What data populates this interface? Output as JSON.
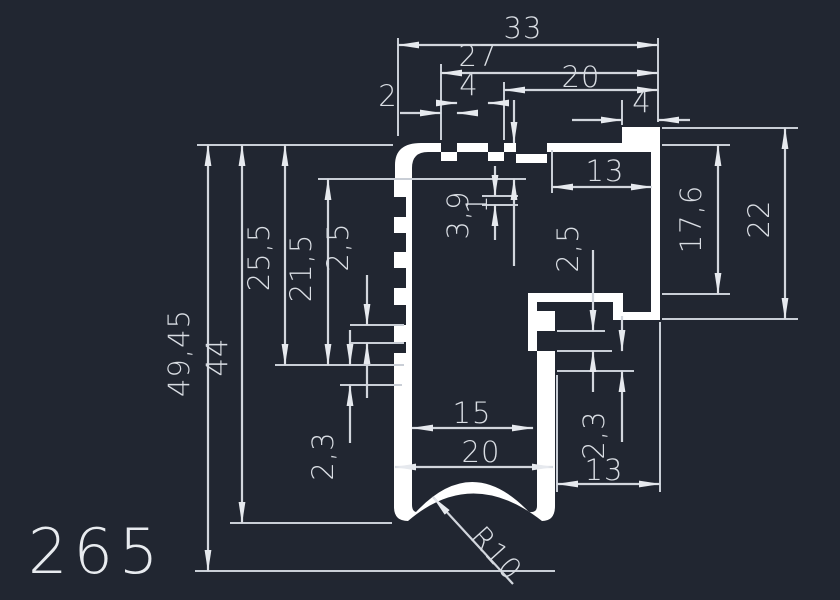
{
  "drawing": {
    "part_number": "265",
    "dims": {
      "width_overall": "33",
      "width_27": "27",
      "width_20_top": "20",
      "groove_4": "4",
      "notch_2": "2",
      "tab_4": "4",
      "width_13_top": "13",
      "depth_3_9": "3,9",
      "depth_1": "1",
      "pitch_2_5_right": "2,5",
      "height_17_6": "17,6",
      "height_22": "22",
      "height_25_5": "25,5",
      "height_21_5": "21,5",
      "pitch_2_5_left": "2,5",
      "height_49_45": "49,45",
      "height_44": "44",
      "thickness_2_3_left": "2,3",
      "thickness_2_3_right": "2,3",
      "width_15": "15",
      "width_20_bottom": "20",
      "width_13_bottom": "13",
      "radius": "R10"
    },
    "colors": {
      "background": "#212631",
      "profile": "#ffffff",
      "dimension": "#d2d6dd"
    }
  }
}
